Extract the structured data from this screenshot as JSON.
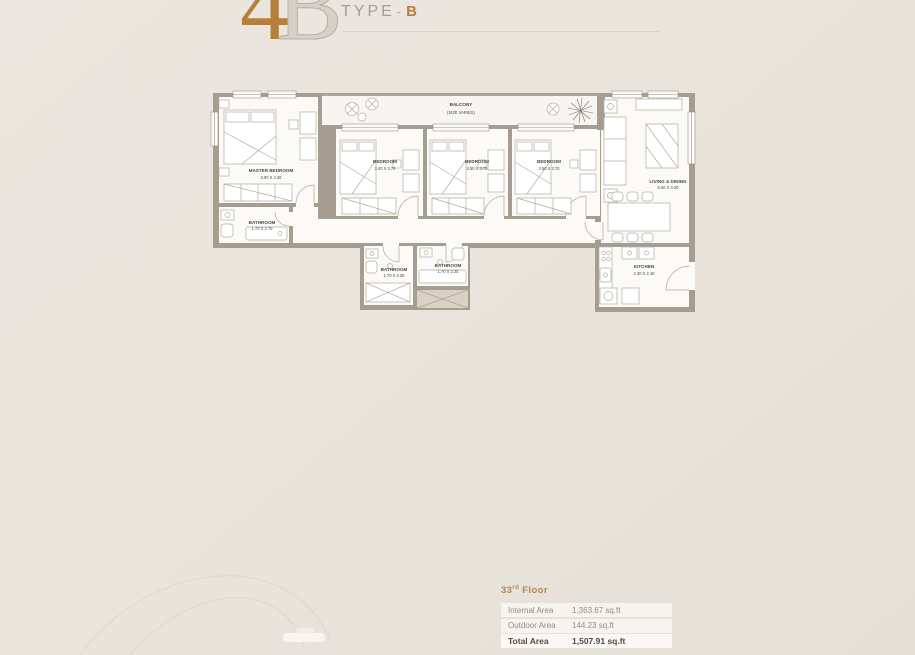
{
  "header": {
    "plan_digit": "4",
    "plan_letter": "B",
    "type_label": "TYPE",
    "type_dash": "-",
    "type_value": "B"
  },
  "floorplan": {
    "balcony": {
      "name": "BALCONY",
      "size": "(SIZE VARIES)"
    },
    "master_bedroom": {
      "name": "MASTER BEDROOM",
      "size": "3.90 X 4.30"
    },
    "master_bathroom": {
      "name": "BATHROOM",
      "size": "1.70 X 2.70"
    },
    "bedroom_1": {
      "name": "BEDROOM",
      "size": "3.40 X 3.70"
    },
    "bedroom_2": {
      "name": "BEDROOM",
      "size": "3.50 X 3.70"
    },
    "bedroom_3": {
      "name": "BEDROOM",
      "size": "3.50 X 3.70"
    },
    "bathroom_1": {
      "name": "BATHROOM",
      "size": "1.70 X 2.30"
    },
    "bathroom_2": {
      "name": "BATHROOM",
      "size": "1.70 X 2.30"
    },
    "kitchen": {
      "name": "KITCHEN",
      "size": "2.30 X 2.40"
    },
    "living_dining": {
      "name": "LIVING & DINING",
      "size": "5.00 X 3.20"
    }
  },
  "area_table": {
    "floor_number": "33",
    "floor_suffix": "rd",
    "floor_word": "Floor",
    "rows": [
      {
        "label": "Internal Area",
        "value": "1,363.67 sq.ft"
      },
      {
        "label": "Outdoor Area",
        "value": "144.23 sq.ft"
      },
      {
        "label": "Total Area",
        "value": "1,507.91 sq.ft"
      }
    ]
  },
  "colors": {
    "accent_bronze": "#b5803c",
    "table_title_bronze": "#b08a4a",
    "wall_gray": "#a59d90",
    "background_beige": "#e9e4dc",
    "room_white": "#fbfaf7"
  }
}
